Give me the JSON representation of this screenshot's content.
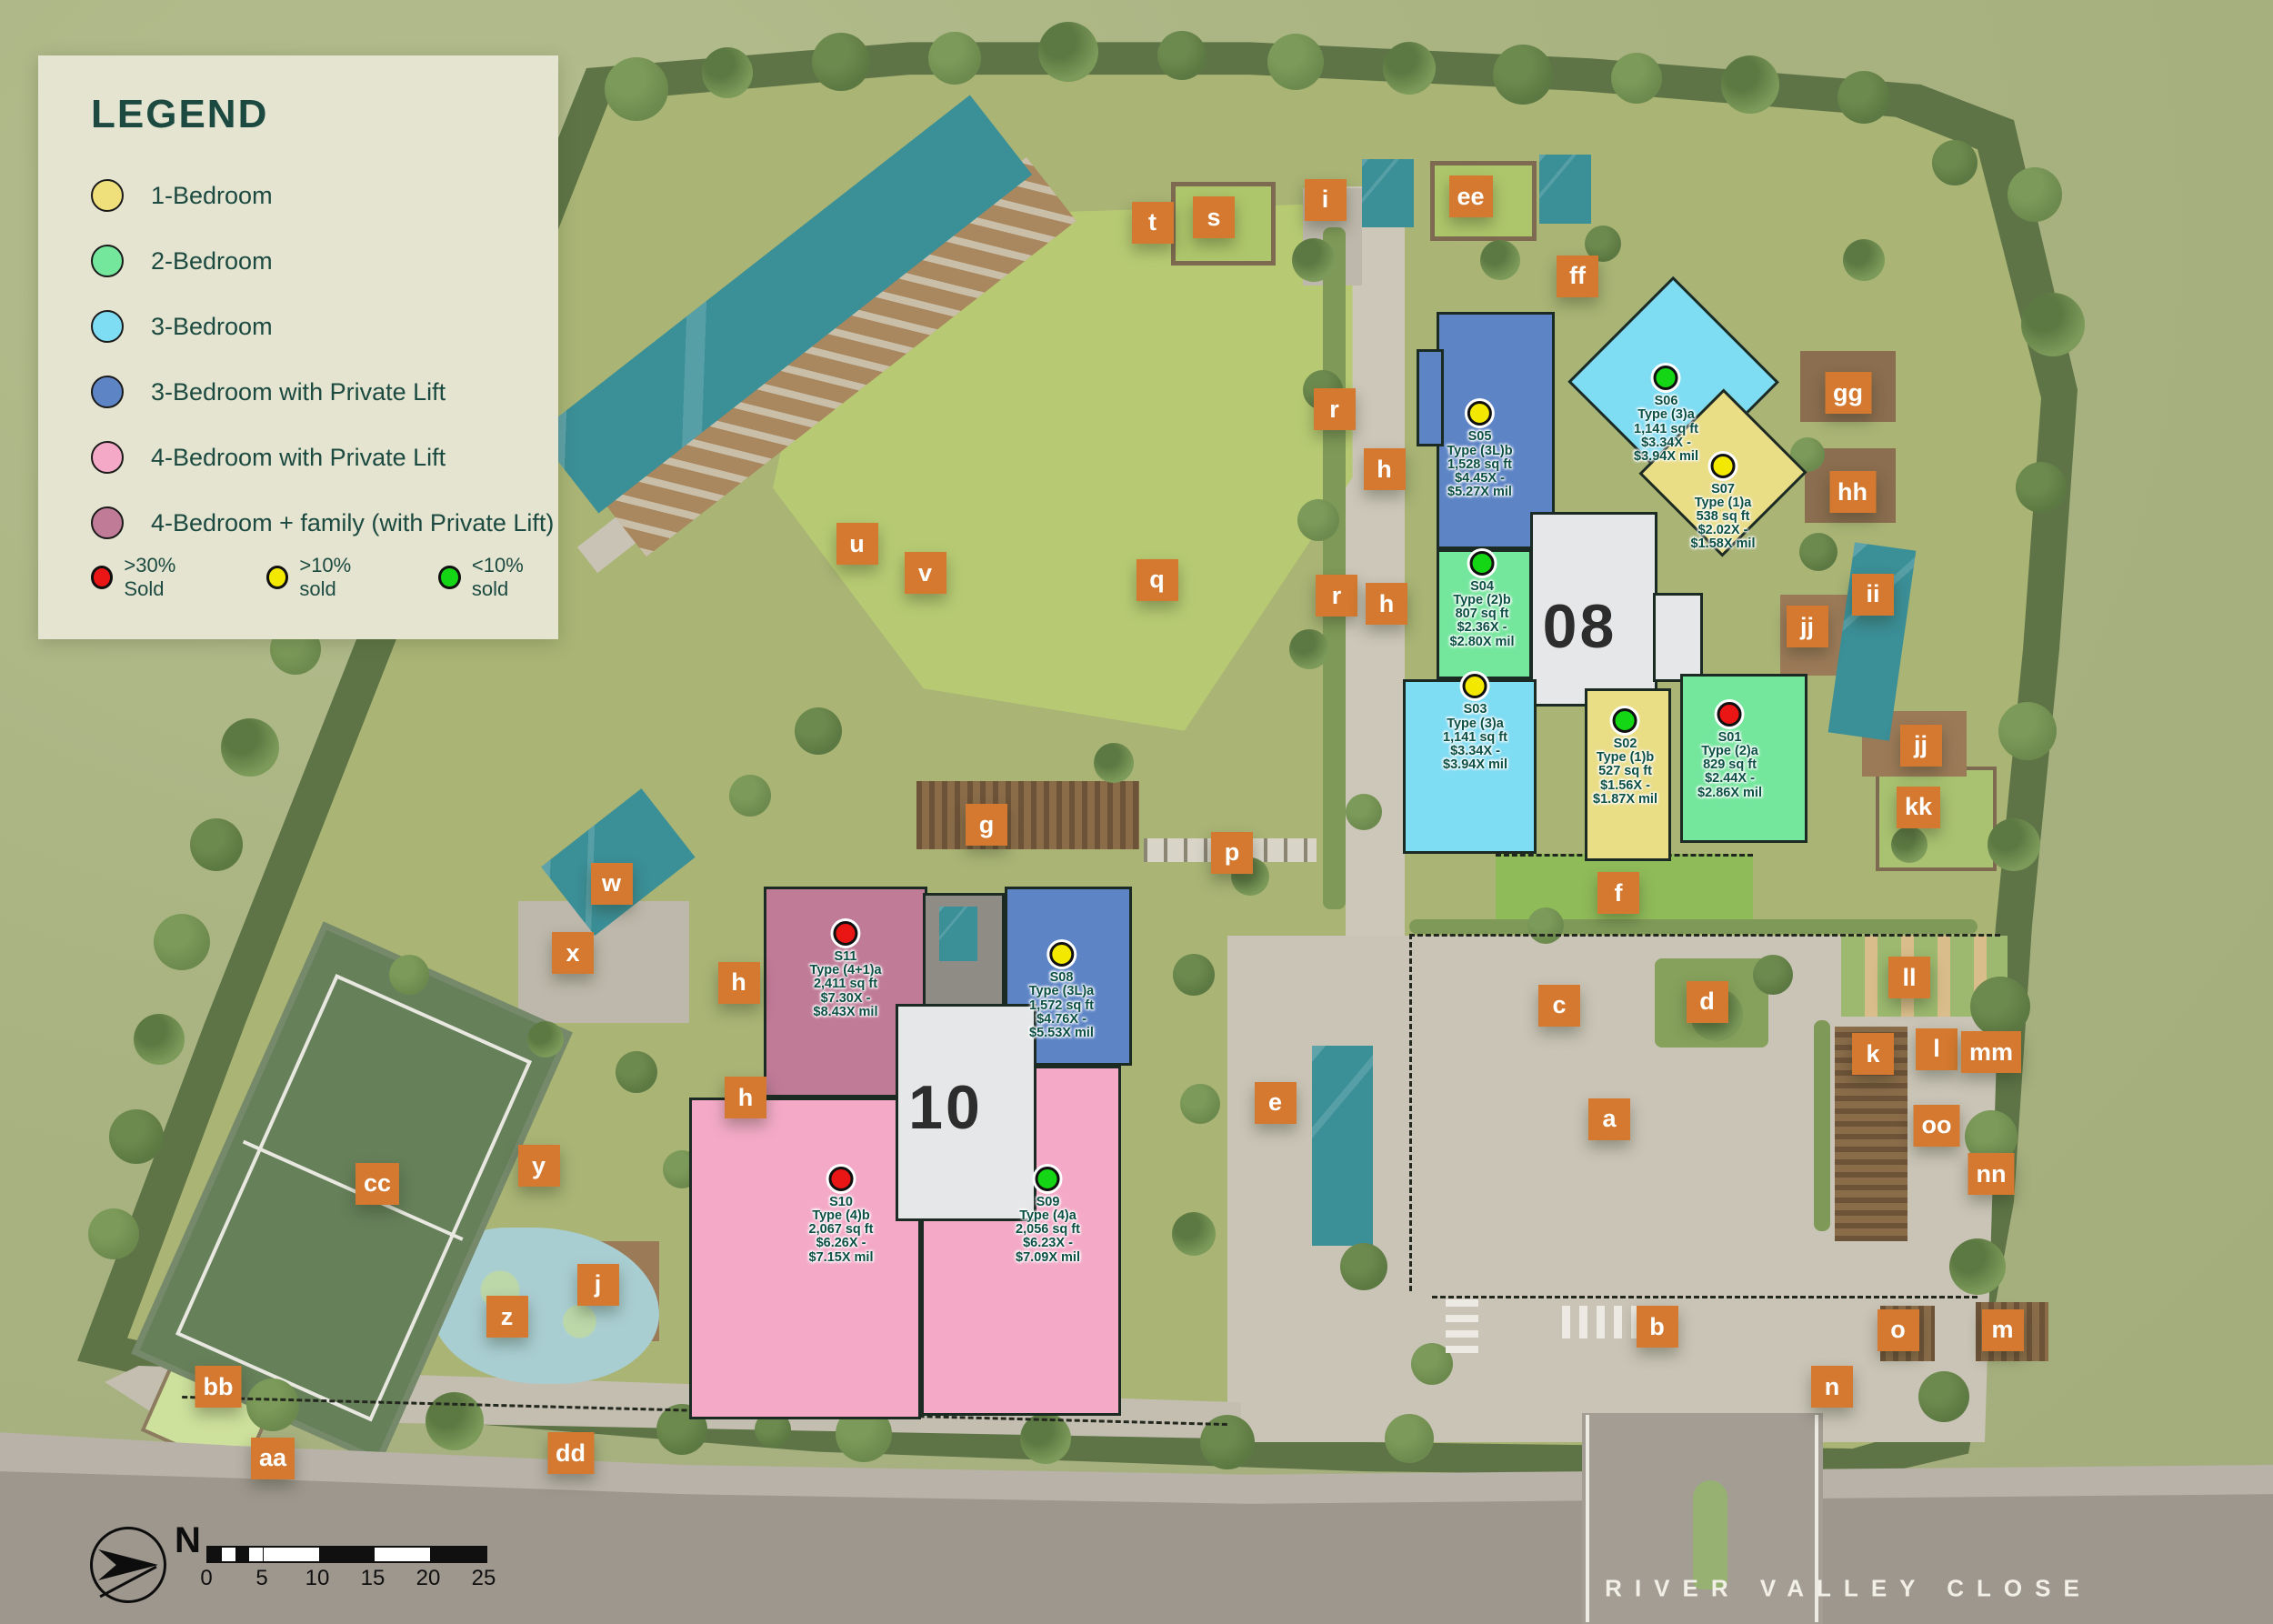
{
  "legend": {
    "title": "LEGEND",
    "items": [
      {
        "label": "1-Bedroom",
        "color": "#f0e07c"
      },
      {
        "label": "2-Bedroom",
        "color": "#74e79d"
      },
      {
        "label": "3-Bedroom",
        "color": "#7edcf3"
      },
      {
        "label": "3-Bedroom with Private Lift",
        "color": "#5d85c6"
      },
      {
        "label": "4-Bedroom with Private Lift",
        "color": "#f4aac7"
      },
      {
        "label": "4-Bedroom + family (with Private Lift)",
        "color": "#c07b97"
      }
    ],
    "sold_status": [
      {
        "label": ">30% Sold",
        "color": "#ea1515"
      },
      {
        "label": ">10% sold",
        "color": "#f3e900"
      },
      {
        "label": "<10% sold",
        "color": "#15d615"
      }
    ]
  },
  "status_colors": {
    "red": "#ea1515",
    "yellow": "#f3e900",
    "green": "#15d615"
  },
  "towers": [
    {
      "number": "08",
      "x": 69.5,
      "y": 38.6
    },
    {
      "number": "10",
      "x": 41.6,
      "y": 68.2
    }
  ],
  "units": [
    {
      "id": "S01",
      "type": "Type (2)a",
      "area": "829 sq ft",
      "price1": "$2.44X -",
      "price2": "$2.86X mil",
      "status": "red",
      "x": 76.1,
      "y": 44.0
    },
    {
      "id": "S02",
      "type": "Type (1)b",
      "area": "527 sq ft",
      "price1": "$1.56X -",
      "price2": "$1.87X mil",
      "status": "green",
      "x": 71.5,
      "y": 44.4
    },
    {
      "id": "S03",
      "type": "Type (3)a",
      "area": "1,141 sq ft",
      "price1": "$3.34X -",
      "price2": "$3.94X mil",
      "status": "yellow",
      "x": 64.9,
      "y": 42.3
    },
    {
      "id": "S04",
      "type": "Type (2)b",
      "area": "807 sq ft",
      "price1": "$2.36X -",
      "price2": "$2.80X mil",
      "status": "green",
      "x": 65.2,
      "y": 34.7
    },
    {
      "id": "S05",
      "type": "Type (3L)b",
      "area": "1,528 sq ft",
      "price1": "$4.45X -",
      "price2": "$5.27X mil",
      "status": "yellow",
      "x": 65.1,
      "y": 25.5
    },
    {
      "id": "S06",
      "type": "Type (3)a",
      "area": "1,141 sq ft",
      "price1": "$3.34X -",
      "price2": "$3.94X mil",
      "status": "green",
      "x": 73.3,
      "y": 23.3
    },
    {
      "id": "S07",
      "type": "Type (1)a",
      "area": "538 sq ft",
      "price1": "$2.02X -",
      "price2": "$1.58X mil",
      "status": "yellow",
      "x": 75.8,
      "y": 28.7
    },
    {
      "id": "S08",
      "type": "Type (3L)a",
      "area": "1,572 sq ft",
      "price1": "$4.76X -",
      "price2": "$5.53X mil",
      "status": "yellow",
      "x": 46.7,
      "y": 58.8
    },
    {
      "id": "S09",
      "type": "Type (4)a",
      "area": "2,056 sq ft",
      "price1": "$6.23X -",
      "price2": "$7.09X mil",
      "status": "green",
      "x": 46.1,
      "y": 72.6
    },
    {
      "id": "S10",
      "type": "Type (4)b",
      "area": "2,067 sq ft",
      "price1": "$6.26X -",
      "price2": "$7.15X mil",
      "status": "red",
      "x": 37.0,
      "y": 72.6
    },
    {
      "id": "S11",
      "type": "Type (4+1)a",
      "area": "2,411 sq ft",
      "price1": "$7.30X -",
      "price2": "$8.43X mil",
      "status": "red",
      "x": 37.2,
      "y": 57.5
    }
  ],
  "markers": [
    {
      "label": "t",
      "x": 50.7,
      "y": 13.7
    },
    {
      "label": "s",
      "x": 53.4,
      "y": 13.4
    },
    {
      "label": "i",
      "x": 58.3,
      "y": 12.3
    },
    {
      "label": "ee",
      "x": 64.7,
      "y": 12.1
    },
    {
      "label": "ff",
      "x": 69.4,
      "y": 17.0
    },
    {
      "label": "r",
      "x": 58.7,
      "y": 25.2
    },
    {
      "label": "h",
      "x": 60.9,
      "y": 28.9
    },
    {
      "label": "gg",
      "x": 81.3,
      "y": 24.2
    },
    {
      "label": "hh",
      "x": 81.5,
      "y": 30.3
    },
    {
      "label": "u",
      "x": 37.7,
      "y": 33.5
    },
    {
      "label": "v",
      "x": 40.7,
      "y": 35.3
    },
    {
      "label": "q",
      "x": 50.9,
      "y": 35.7
    },
    {
      "label": "r",
      "x": 58.8,
      "y": 36.7
    },
    {
      "label": "h",
      "x": 61.0,
      "y": 37.2
    },
    {
      "label": "ii",
      "x": 82.4,
      "y": 36.6
    },
    {
      "label": "jj",
      "x": 79.5,
      "y": 38.6
    },
    {
      "label": "jj",
      "x": 84.5,
      "y": 45.9
    },
    {
      "label": "kk",
      "x": 84.4,
      "y": 49.7
    },
    {
      "label": "g",
      "x": 43.4,
      "y": 50.8
    },
    {
      "label": "p",
      "x": 54.2,
      "y": 52.5
    },
    {
      "label": "f",
      "x": 71.2,
      "y": 55.0
    },
    {
      "label": "w",
      "x": 26.9,
      "y": 54.4
    },
    {
      "label": "x",
      "x": 25.2,
      "y": 58.7
    },
    {
      "label": "h",
      "x": 32.5,
      "y": 60.5
    },
    {
      "label": "c",
      "x": 68.6,
      "y": 61.9
    },
    {
      "label": "d",
      "x": 75.1,
      "y": 61.7
    },
    {
      "label": "ll",
      "x": 84.0,
      "y": 60.2
    },
    {
      "label": "h",
      "x": 32.8,
      "y": 67.6
    },
    {
      "label": "k",
      "x": 82.4,
      "y": 64.9
    },
    {
      "label": "l",
      "x": 85.2,
      "y": 64.6
    },
    {
      "label": "mm",
      "x": 87.6,
      "y": 64.8
    },
    {
      "label": "y",
      "x": 23.7,
      "y": 71.8
    },
    {
      "label": "oo",
      "x": 85.2,
      "y": 69.3
    },
    {
      "label": "a",
      "x": 70.8,
      "y": 68.9
    },
    {
      "label": "e",
      "x": 56.1,
      "y": 67.9
    },
    {
      "label": "cc",
      "x": 16.6,
      "y": 72.9
    },
    {
      "label": "nn",
      "x": 87.6,
      "y": 72.3
    },
    {
      "label": "j",
      "x": 26.3,
      "y": 79.1
    },
    {
      "label": "z",
      "x": 22.3,
      "y": 81.1
    },
    {
      "label": "b",
      "x": 72.9,
      "y": 81.7
    },
    {
      "label": "o",
      "x": 83.5,
      "y": 81.9
    },
    {
      "label": "m",
      "x": 88.1,
      "y": 81.9
    },
    {
      "label": "bb",
      "x": 9.6,
      "y": 85.4
    },
    {
      "label": "aa",
      "x": 12.0,
      "y": 89.8
    },
    {
      "label": "dd",
      "x": 25.1,
      "y": 89.5
    },
    {
      "label": "n",
      "x": 80.6,
      "y": 85.4
    }
  ],
  "map": {
    "road_name": "RIVER VALLEY CLOSE",
    "compass_label": "N",
    "scale_ticks": [
      "0",
      "5",
      "10",
      "15",
      "20",
      "25"
    ]
  }
}
